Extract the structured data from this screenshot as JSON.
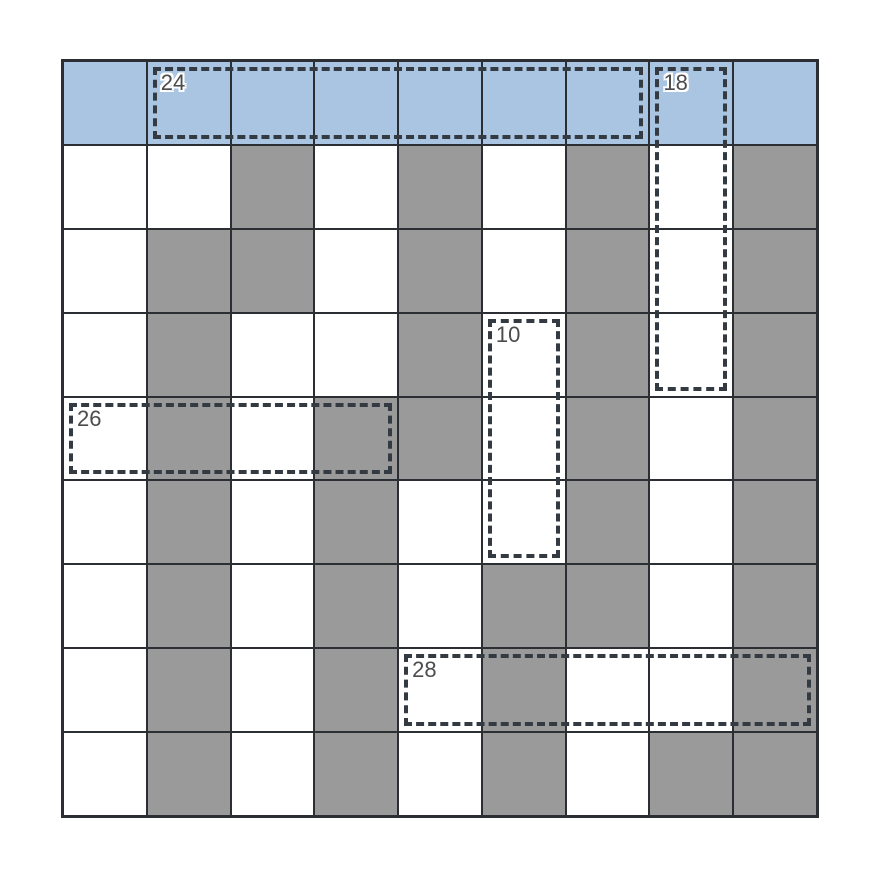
{
  "puzzle": {
    "title": "shaded-grid-sum-puzzle",
    "grid_size": {
      "rows": 9,
      "cols": 9
    },
    "colors": {
      "blue": "#a9c5e2",
      "gray": "#9a9a9a",
      "white": "#ffffff",
      "line": "#2b2e33",
      "dash": "#333a42",
      "label": "#4c4c4c"
    },
    "legend": {
      "B": "blue-cell",
      "G": "gray-cell",
      "W": "white-cell"
    },
    "rows": [
      "BBBBBBBBB",
      "WWGWGWGWG",
      "WGGWGWGWG",
      "WGWWGWGWG",
      "WGWGGWGWG",
      "WGWGWWGWG",
      "WGWGWGGWG",
      "WGWGWGWWG",
      "WGWGWGWGG"
    ],
    "groups": [
      {
        "label": "24",
        "row": 0,
        "col": 1,
        "rowspan": 1,
        "colspan": 6
      },
      {
        "label": "18",
        "row": 0,
        "col": 7,
        "rowspan": 4,
        "colspan": 1
      },
      {
        "label": "10",
        "row": 3,
        "col": 5,
        "rowspan": 3,
        "colspan": 1
      },
      {
        "label": "26",
        "row": 4,
        "col": 0,
        "rowspan": 1,
        "colspan": 4
      },
      {
        "label": "28",
        "row": 7,
        "col": 4,
        "rowspan": 1,
        "colspan": 5
      }
    ]
  }
}
